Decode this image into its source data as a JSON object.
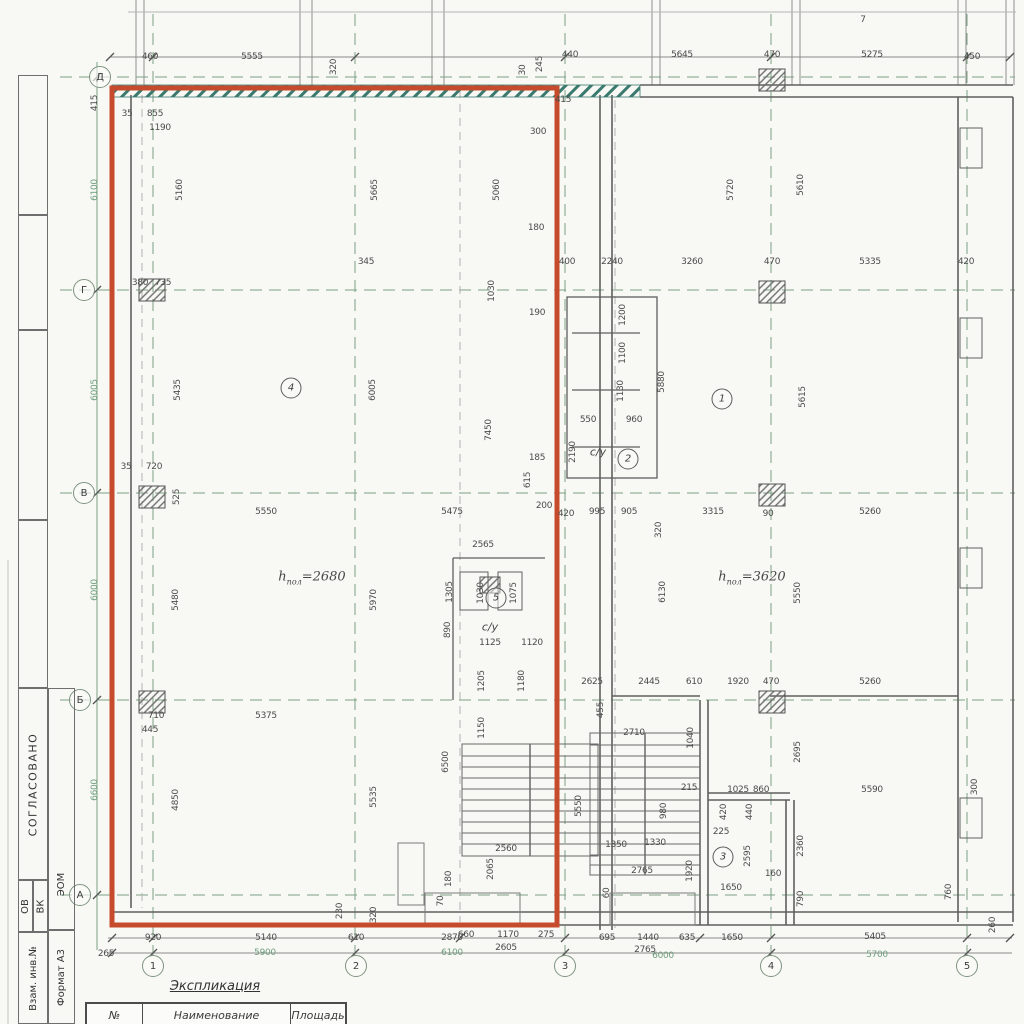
{
  "palette": {
    "highlight_red": "#c64a2c",
    "grid_green": "#7da283",
    "wall_teal": "#3a7a6e",
    "line_gray": "#5f5f5f"
  },
  "sidebar": {
    "approved": "СОГЛАСОВАНО",
    "ov": "ОВ",
    "vk": "ВК",
    "eom": "ЭОМ",
    "stamp": "Взам. инв.№",
    "format": "Формат А3"
  },
  "legend": {
    "title": "Экспликация",
    "columns": [
      "№",
      "Наименование",
      "Площадь"
    ]
  },
  "grid": {
    "rows": [
      {
        "l": "Д",
        "x": 100,
        "y": 77
      },
      {
        "l": "Г",
        "x": 84,
        "y": 290
      },
      {
        "l": "В",
        "x": 84,
        "y": 493
      },
      {
        "l": "Б",
        "x": 80,
        "y": 700
      },
      {
        "l": "А",
        "x": 80,
        "y": 895
      }
    ],
    "cols": [
      {
        "l": "1",
        "x": 153,
        "y": 966
      },
      {
        "l": "2",
        "x": 356,
        "y": 966
      },
      {
        "l": "3",
        "x": 565,
        "y": 966
      },
      {
        "l": "4",
        "x": 771,
        "y": 966
      },
      {
        "l": "5",
        "x": 967,
        "y": 966
      }
    ]
  },
  "rooms": [
    {
      "n": "4",
      "x": 291,
      "y": 388
    },
    {
      "n": "1",
      "x": 722,
      "y": 399
    },
    {
      "n": "2",
      "x": 628,
      "y": 459
    },
    {
      "n": "5",
      "x": 496,
      "y": 598
    },
    {
      "n": "3",
      "x": 723,
      "y": 857
    }
  ],
  "room_labels": [
    {
      "t": "с/у",
      "x": 598,
      "y": 452
    },
    {
      "t": "с/у",
      "x": 490,
      "y": 627
    }
  ],
  "heights": [
    {
      "pre": "h",
      "sub": "пол",
      "val": "=2680",
      "x": 312,
      "y": 578
    },
    {
      "pre": "h",
      "sub": "пол",
      "val": "=3620",
      "x": 752,
      "y": 578
    }
  ],
  "dims": [
    {
      "t": "460",
      "x": 150,
      "y": 57
    },
    {
      "t": "5555",
      "x": 252,
      "y": 57
    },
    {
      "t": "320",
      "x": 334,
      "y": 67,
      "r": 1
    },
    {
      "t": "30",
      "x": 523,
      "y": 70,
      "r": 1
    },
    {
      "t": "245",
      "x": 540,
      "y": 64,
      "r": 1
    },
    {
      "t": "440",
      "x": 570,
      "y": 55
    },
    {
      "t": "5645",
      "x": 682,
      "y": 55
    },
    {
      "t": "470",
      "x": 772,
      "y": 55
    },
    {
      "t": "5275",
      "x": 872,
      "y": 55
    },
    {
      "t": "450",
      "x": 972,
      "y": 57
    },
    {
      "t": "7",
      "x": 863,
      "y": 20
    },
    {
      "t": "415",
      "x": 95,
      "y": 103,
      "r": 1
    },
    {
      "t": "415",
      "x": 563,
      "y": 100
    },
    {
      "t": "300",
      "x": 538,
      "y": 132
    },
    {
      "t": "35",
      "x": 127,
      "y": 114
    },
    {
      "t": "855",
      "x": 155,
      "y": 114
    },
    {
      "t": "1190",
      "x": 160,
      "y": 128
    },
    {
      "t": "6100",
      "x": 95,
      "y": 190,
      "r": 1,
      "g": 1
    },
    {
      "t": "6005",
      "x": 95,
      "y": 390,
      "r": 1,
      "g": 1
    },
    {
      "t": "6000",
      "x": 95,
      "y": 590,
      "r": 1,
      "g": 1
    },
    {
      "t": "6600",
      "x": 95,
      "y": 790,
      "r": 1,
      "g": 1
    },
    {
      "t": "5160",
      "x": 180,
      "y": 190,
      "r": 1
    },
    {
      "t": "5665",
      "x": 375,
      "y": 190,
      "r": 1
    },
    {
      "t": "5060",
      "x": 497,
      "y": 190,
      "r": 1
    },
    {
      "t": "5720",
      "x": 731,
      "y": 190,
      "r": 1
    },
    {
      "t": "5610",
      "x": 801,
      "y": 185,
      "r": 1
    },
    {
      "t": "180",
      "x": 536,
      "y": 228
    },
    {
      "t": "380",
      "x": 140,
      "y": 283
    },
    {
      "t": "735",
      "x": 163,
      "y": 283
    },
    {
      "t": "345",
      "x": 366,
      "y": 262
    },
    {
      "t": "400",
      "x": 567,
      "y": 262
    },
    {
      "t": "2240",
      "x": 612,
      "y": 262
    },
    {
      "t": "3260",
      "x": 692,
      "y": 262
    },
    {
      "t": "470",
      "x": 772,
      "y": 262
    },
    {
      "t": "5335",
      "x": 870,
      "y": 262
    },
    {
      "t": "420",
      "x": 966,
      "y": 262
    },
    {
      "t": "1030",
      "x": 492,
      "y": 291,
      "r": 1
    },
    {
      "t": "190",
      "x": 537,
      "y": 313
    },
    {
      "t": "1200",
      "x": 623,
      "y": 315,
      "r": 1
    },
    {
      "t": "1100",
      "x": 623,
      "y": 353,
      "r": 1
    },
    {
      "t": "1130",
      "x": 621,
      "y": 391,
      "r": 1
    },
    {
      "t": "5880",
      "x": 662,
      "y": 382,
      "r": 1
    },
    {
      "t": "5615",
      "x": 803,
      "y": 397,
      "r": 1
    },
    {
      "t": "5435",
      "x": 178,
      "y": 390,
      "r": 1
    },
    {
      "t": "6005",
      "x": 373,
      "y": 390,
      "r": 1
    },
    {
      "t": "7450",
      "x": 489,
      "y": 430,
      "r": 1
    },
    {
      "t": "550",
      "x": 588,
      "y": 420
    },
    {
      "t": "960",
      "x": 634,
      "y": 420
    },
    {
      "t": "2190",
      "x": 573,
      "y": 452,
      "r": 1
    },
    {
      "t": "185",
      "x": 537,
      "y": 458
    },
    {
      "t": "615",
      "x": 528,
      "y": 480,
      "r": 1
    },
    {
      "t": "35",
      "x": 126,
      "y": 467
    },
    {
      "t": "720",
      "x": 154,
      "y": 467
    },
    {
      "t": "525",
      "x": 177,
      "y": 497,
      "r": 1
    },
    {
      "t": "200",
      "x": 544,
      "y": 506
    },
    {
      "t": "5550",
      "x": 266,
      "y": 512
    },
    {
      "t": "5475",
      "x": 452,
      "y": 512
    },
    {
      "t": "420",
      "x": 566,
      "y": 514
    },
    {
      "t": "995",
      "x": 597,
      "y": 512
    },
    {
      "t": "905",
      "x": 629,
      "y": 512
    },
    {
      "t": "320",
      "x": 659,
      "y": 530,
      "r": 1
    },
    {
      "t": "3315",
      "x": 713,
      "y": 512
    },
    {
      "t": "90",
      "x": 768,
      "y": 514
    },
    {
      "t": "5260",
      "x": 870,
      "y": 512
    },
    {
      "t": "2565",
      "x": 483,
      "y": 545
    },
    {
      "t": "5480",
      "x": 176,
      "y": 600,
      "r": 1
    },
    {
      "t": "5970",
      "x": 374,
      "y": 600,
      "r": 1
    },
    {
      "t": "6130",
      "x": 663,
      "y": 592,
      "r": 1
    },
    {
      "t": "5550",
      "x": 798,
      "y": 593,
      "r": 1
    },
    {
      "t": "1305",
      "x": 450,
      "y": 592,
      "r": 1
    },
    {
      "t": "1030",
      "x": 481,
      "y": 593,
      "r": 1
    },
    {
      "t": "1075",
      "x": 514,
      "y": 593,
      "r": 1
    },
    {
      "t": "890",
      "x": 448,
      "y": 630,
      "r": 1
    },
    {
      "t": "1125",
      "x": 490,
      "y": 643
    },
    {
      "t": "1120",
      "x": 532,
      "y": 643
    },
    {
      "t": "1205",
      "x": 482,
      "y": 681,
      "r": 1
    },
    {
      "t": "1180",
      "x": 522,
      "y": 681,
      "r": 1
    },
    {
      "t": "2625",
      "x": 592,
      "y": 682
    },
    {
      "t": "2445",
      "x": 649,
      "y": 682
    },
    {
      "t": "610",
      "x": 694,
      "y": 682
    },
    {
      "t": "1920",
      "x": 738,
      "y": 682
    },
    {
      "t": "470",
      "x": 771,
      "y": 682
    },
    {
      "t": "5260",
      "x": 870,
      "y": 682
    },
    {
      "t": "455",
      "x": 601,
      "y": 710,
      "r": 1
    },
    {
      "t": "710",
      "x": 156,
      "y": 716
    },
    {
      "t": "445",
      "x": 150,
      "y": 730
    },
    {
      "t": "5375",
      "x": 266,
      "y": 716
    },
    {
      "t": "4850",
      "x": 176,
      "y": 800,
      "r": 1
    },
    {
      "t": "5535",
      "x": 374,
      "y": 797,
      "r": 1
    },
    {
      "t": "6500",
      "x": 446,
      "y": 762,
      "r": 1
    },
    {
      "t": "1150",
      "x": 482,
      "y": 728,
      "r": 1
    },
    {
      "t": "5550",
      "x": 579,
      "y": 806,
      "r": 1
    },
    {
      "t": "2560",
      "x": 506,
      "y": 849
    },
    {
      "t": "2065",
      "x": 491,
      "y": 869,
      "r": 1
    },
    {
      "t": "180",
      "x": 449,
      "y": 879,
      "r": 1
    },
    {
      "t": "70",
      "x": 441,
      "y": 901,
      "r": 1
    },
    {
      "t": "230",
      "x": 340,
      "y": 911,
      "r": 1
    },
    {
      "t": "320",
      "x": 374,
      "y": 915,
      "r": 1
    },
    {
      "t": "2710",
      "x": 634,
      "y": 733
    },
    {
      "t": "1040",
      "x": 691,
      "y": 738,
      "r": 1
    },
    {
      "t": "215",
      "x": 689,
      "y": 788
    },
    {
      "t": "980",
      "x": 664,
      "y": 811,
      "r": 1
    },
    {
      "t": "1350",
      "x": 616,
      "y": 845
    },
    {
      "t": "1330",
      "x": 655,
      "y": 843
    },
    {
      "t": "2765",
      "x": 642,
      "y": 871
    },
    {
      "t": "1920",
      "x": 690,
      "y": 871,
      "r": 1
    },
    {
      "t": "60",
      "x": 607,
      "y": 893,
      "r": 1
    },
    {
      "t": "2695",
      "x": 798,
      "y": 752,
      "r": 1
    },
    {
      "t": "1025",
      "x": 738,
      "y": 790
    },
    {
      "t": "860",
      "x": 761,
      "y": 790
    },
    {
      "t": "420",
      "x": 724,
      "y": 812,
      "r": 1
    },
    {
      "t": "440",
      "x": 750,
      "y": 812,
      "r": 1
    },
    {
      "t": "225",
      "x": 721,
      "y": 832
    },
    {
      "t": "2595",
      "x": 748,
      "y": 856,
      "r": 1
    },
    {
      "t": "160",
      "x": 773,
      "y": 874
    },
    {
      "t": "2360",
      "x": 801,
      "y": 846,
      "r": 1
    },
    {
      "t": "5590",
      "x": 872,
      "y": 790
    },
    {
      "t": "300",
      "x": 975,
      "y": 787,
      "r": 1
    },
    {
      "t": "790",
      "x": 801,
      "y": 899,
      "r": 1
    },
    {
      "t": "760",
      "x": 949,
      "y": 892,
      "r": 1
    },
    {
      "t": "1650",
      "x": 731,
      "y": 888
    },
    {
      "t": "265",
      "x": 106,
      "y": 954
    },
    {
      "t": "920",
      "x": 153,
      "y": 938
    },
    {
      "t": "5140",
      "x": 266,
      "y": 938
    },
    {
      "t": "5900",
      "x": 265,
      "y": 953,
      "g": 1
    },
    {
      "t": "610",
      "x": 356,
      "y": 938
    },
    {
      "t": "2870",
      "x": 452,
      "y": 938
    },
    {
      "t": "6100",
      "x": 452,
      "y": 953,
      "g": 1
    },
    {
      "t": "660",
      "x": 466,
      "y": 935
    },
    {
      "t": "1170",
      "x": 508,
      "y": 935
    },
    {
      "t": "275",
      "x": 546,
      "y": 935
    },
    {
      "t": "2605",
      "x": 506,
      "y": 948
    },
    {
      "t": "695",
      "x": 607,
      "y": 938
    },
    {
      "t": "1440",
      "x": 648,
      "y": 938
    },
    {
      "t": "635",
      "x": 687,
      "y": 938
    },
    {
      "t": "2765",
      "x": 645,
      "y": 950
    },
    {
      "t": "6000",
      "x": 663,
      "y": 956,
      "g": 1
    },
    {
      "t": "1650",
      "x": 732,
      "y": 938
    },
    {
      "t": "5405",
      "x": 875,
      "y": 937
    },
    {
      "t": "5700",
      "x": 877,
      "y": 955,
      "g": 1
    },
    {
      "t": "260",
      "x": 993,
      "y": 925,
      "r": 1
    }
  ]
}
